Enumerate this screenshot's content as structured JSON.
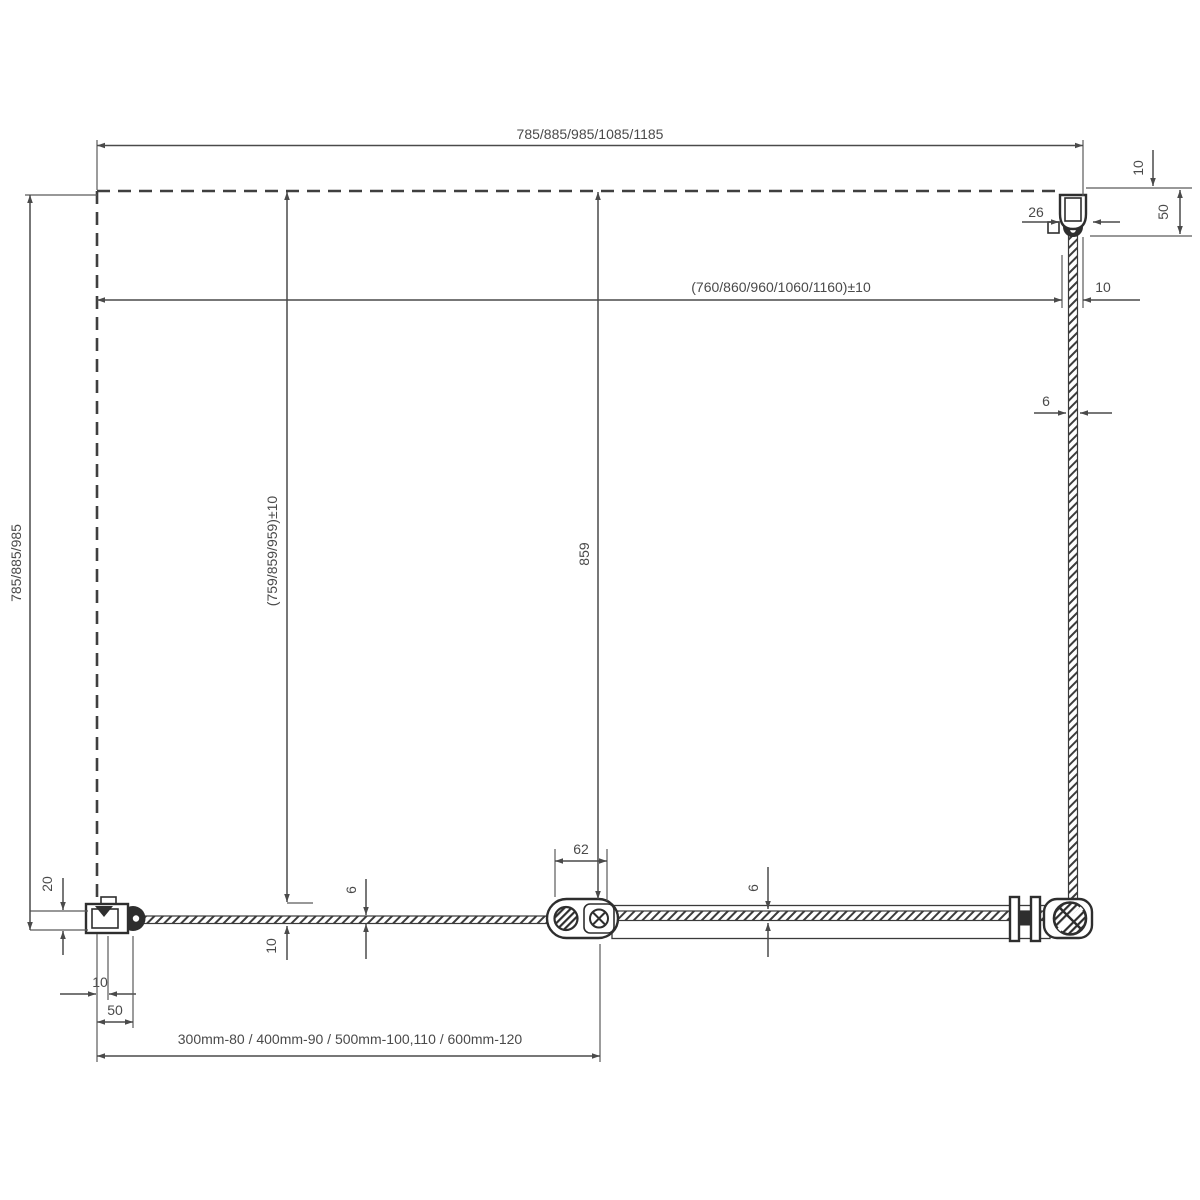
{
  "diagram": {
    "type": "technical-drawing-plan-view",
    "subject": "shower-enclosure-door-with-fixed-side-panel",
    "colors": {
      "background": "#ffffff",
      "line": "#4a4a4a",
      "hardware": "#2e2e2e"
    },
    "labels": {
      "top_width": "785/885/985/1085/1185",
      "inner_width": "(760/860/960/1060/1160)±10",
      "side_adjust": "10",
      "profile_depth": "26",
      "top_offset": "10",
      "profile_height": "50",
      "side_glass_thickness": "6",
      "left_height": "785/885/985",
      "wall_clearance": "20",
      "inner_height": "(759/859/959)±10",
      "glass_offset": "10",
      "fixed_glass_thickness": "6",
      "door_width": "859",
      "hinge_width": "62",
      "door_glass_thickness": "6",
      "wall_gap": "10",
      "profile_width": "50",
      "extension_range": "300mm-80 / 400mm-90 / 500mm-100,110 / 600mm-120"
    }
  }
}
